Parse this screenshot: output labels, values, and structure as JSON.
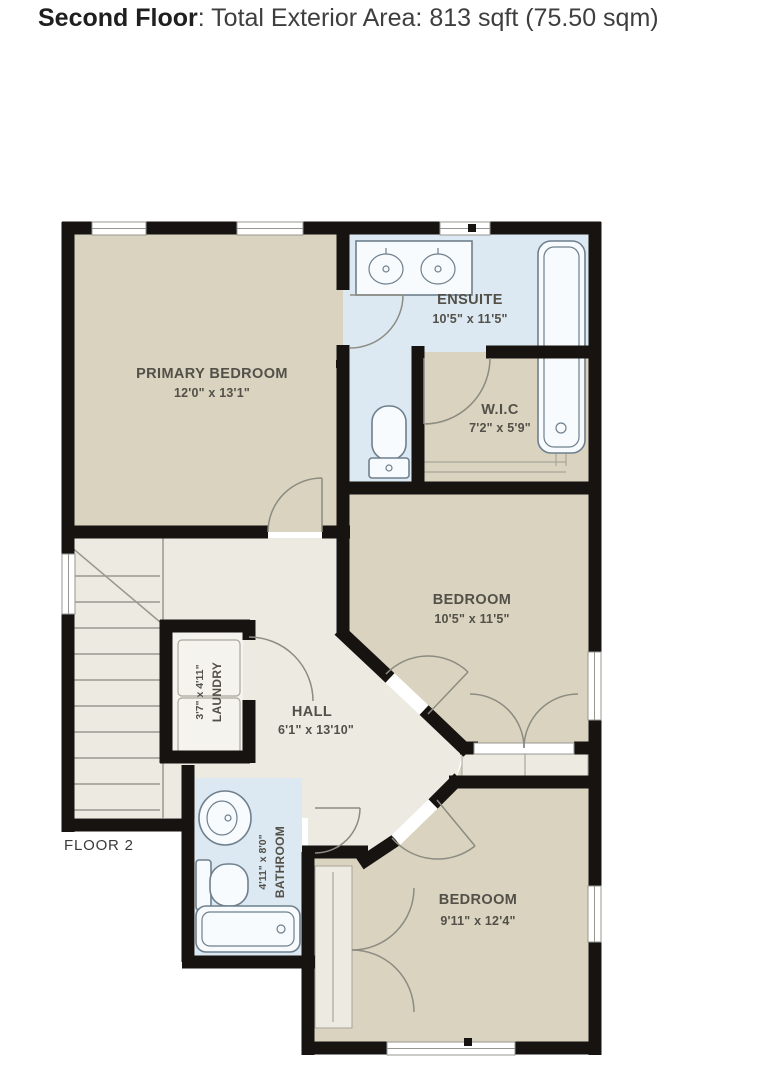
{
  "title": {
    "prefix": "Second Floor",
    "suffix": ": Total Exterior Area: 813 sqft (75.50 sqm)"
  },
  "floor_label": "FLOOR 2",
  "rooms": {
    "primary_bedroom": {
      "name": "PRIMARY BEDROOM",
      "dims": "12'0\" x 13'1\""
    },
    "ensuite": {
      "name": "ENSUITE",
      "dims": "10'5\" x 11'5\""
    },
    "wic": {
      "name": "W.I.C",
      "dims": "7'2\" x 5'9\""
    },
    "bedroom_mid": {
      "name": "BEDROOM",
      "dims": "10'5\" x 11'5\""
    },
    "hall": {
      "name": "HALL",
      "dims": "6'1\" x 13'10\""
    },
    "laundry": {
      "name": "LAUNDRY",
      "dims": "3'7\" x 4'11\""
    },
    "bathroom": {
      "name": "BATHROOM",
      "dims": "4'11\" x 8'0\""
    },
    "bedroom_bottom": {
      "name": "BEDROOM",
      "dims": "9'11\" x 12'4\""
    }
  },
  "colors": {
    "wall": "#161310",
    "bedroom_fill": "#d9d3bf",
    "wet_fill": "#dce8f2",
    "hall_fill": "#edeae2",
    "laundry_fill": "#f4f3ee",
    "fixture_stroke": "#6e7f8d",
    "label": "#525048"
  }
}
